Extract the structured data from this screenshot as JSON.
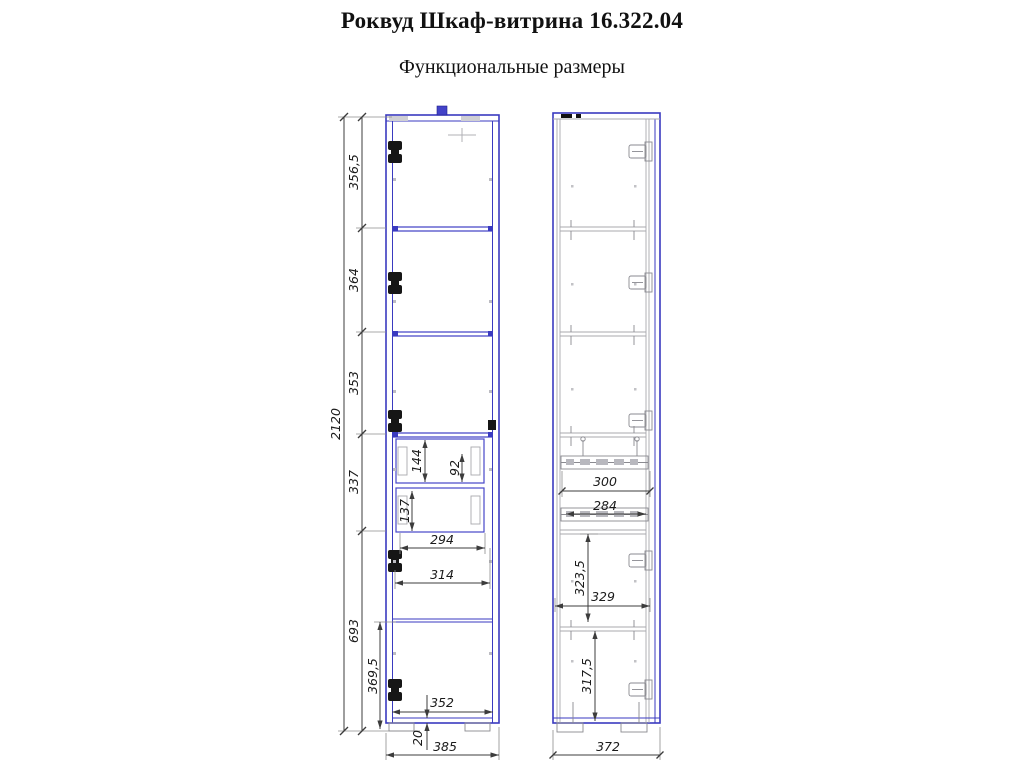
{
  "page": {
    "title": "Роквуд Шкаф-витрина 16.322.04",
    "subtitle": "Функциональные размеры"
  },
  "drawing": {
    "kind": "furniture dimension diagram, front view and side section view",
    "front": {
      "overall_height": "2120",
      "overall_width": "385",
      "sections": [
        "356,5",
        "364",
        "353",
        "337",
        "693"
      ],
      "bottom_compartment_height": "369,5",
      "drawer_top_inner_height": "144",
      "drawer_top_front_height": "92",
      "drawer_bottom_inner_height": "137",
      "drawer_inner_width": "294",
      "drawer_opening_width": "314",
      "bottom_inner_width": "352",
      "base_thickness": "20"
    },
    "side": {
      "overall_depth": "372",
      "slide_outer_length": "300",
      "slide_inner_length": "284",
      "below_drawer_height": "323,5",
      "inner_depth": "329",
      "bottom_inner_height": "317,5"
    }
  }
}
